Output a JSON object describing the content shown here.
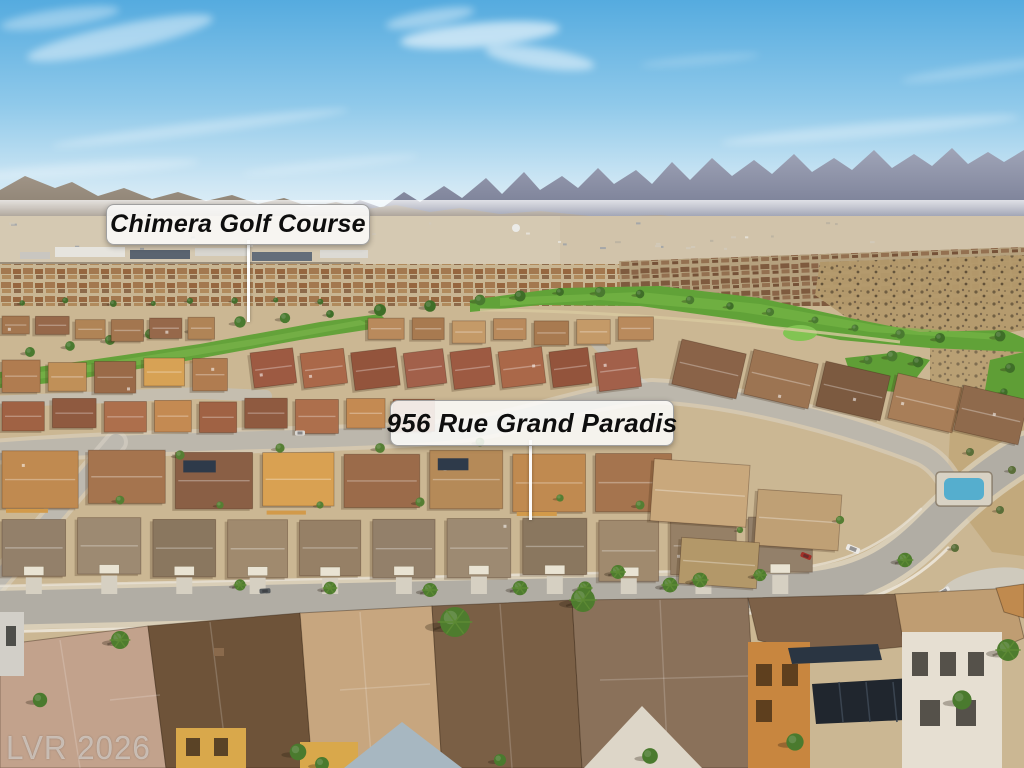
{
  "image": {
    "type": "aerial-photograph",
    "scene": "Aerial drone view of a desert residential neighborhood beside a golf course, with mountains and blue sky on the horizon",
    "callouts": [
      {
        "id": "golf-course",
        "text": "Chimera Golf Course"
      },
      {
        "id": "property-address",
        "text": "956 Rue Grand Paradis"
      }
    ],
    "watermark": {
      "text": "LVR 2026"
    },
    "palette": {
      "sky": "#5fb0e0",
      "mountains": "#8a90a8",
      "desert": "#c9b68f",
      "golf_green": "#61a238",
      "roof_brown": "#9a6b4a",
      "street": "#b1ada4",
      "callout_background": "#fbfbfa",
      "callout_text": "#0e0e0e"
    }
  }
}
